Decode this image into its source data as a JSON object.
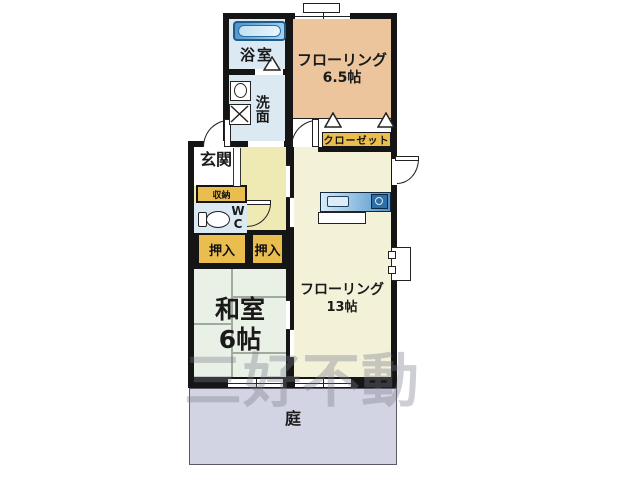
{
  "watermark": "三好不動",
  "rooms": {
    "bathroom": {
      "label": "浴室"
    },
    "washroom": {
      "label": "洗面"
    },
    "flooring65": {
      "line1": "フローリング",
      "line2": "6.5帖"
    },
    "closet": {
      "label": "クローゼット"
    },
    "entrance": {
      "label": "玄関"
    },
    "storage": {
      "label": "収納"
    },
    "wc": {
      "line1": "W",
      "line2": "C"
    },
    "oshiire_left": {
      "label": "押入"
    },
    "oshiire_right": {
      "label": "押入"
    },
    "flooring13": {
      "line1": "フローリング",
      "line2": "13帖"
    },
    "washitsu": {
      "line1": "和室",
      "line2": "6帖"
    },
    "garden": {
      "label": "庭"
    }
  },
  "colors": {
    "wall": "#151515",
    "bath": "#dbe9f3",
    "peach": "#ecc59c",
    "cream": "#f4f1d9",
    "hall": "#efe9b4",
    "gold": "#e9bd4e",
    "washitsu_fill": "#e9f1e7",
    "garden_fill": "#d3d4e3",
    "tatami": "#9fab9f",
    "counter_dark": "#4e93c8",
    "counter_light": "#d6ecf8"
  }
}
